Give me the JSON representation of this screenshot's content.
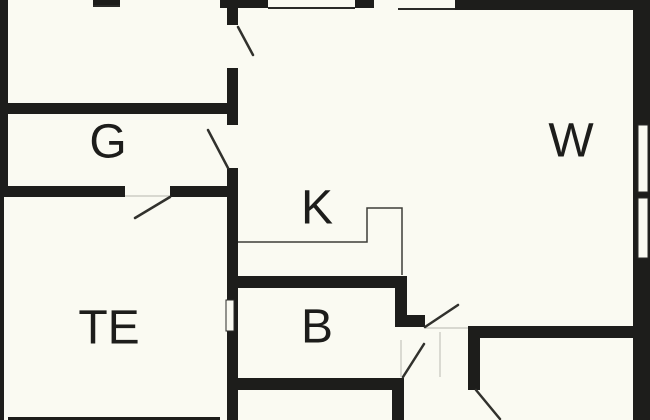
{
  "canvas": {
    "width": 650,
    "height": 420,
    "background_color": "#fafaf2",
    "wall_color": "#1d1d1b",
    "label_color": "#1d1d1b",
    "label_font_size": 48,
    "door_color": "#31312d",
    "counter_color": "#3c3c38",
    "window_line_color": "#2a2a28",
    "faint_line_color": "#c4c4bc"
  },
  "rooms": [
    {
      "label": "G",
      "x": 108,
      "y": 142
    },
    {
      "label": "W",
      "x": 571,
      "y": 141
    },
    {
      "label": "K",
      "x": 317,
      "y": 208
    },
    {
      "label": "TE",
      "x": 109,
      "y": 328
    },
    {
      "label": "B",
      "x": 317,
      "y": 327
    }
  ],
  "walls": [
    {
      "name": "wall-left-upper",
      "x": 0,
      "y": 0,
      "w": 8,
      "h": 197
    },
    {
      "name": "wall-left-lower",
      "x": 0,
      "y": 192,
      "w": 4,
      "h": 228
    },
    {
      "name": "wall-top-entry-mark",
      "x": 93,
      "y": 0,
      "w": 27,
      "h": 5
    },
    {
      "name": "wall-top-a",
      "x": 220,
      "y": 0,
      "w": 48,
      "h": 8
    },
    {
      "name": "wall-top-b",
      "x": 355,
      "y": 0,
      "w": 19,
      "h": 8
    },
    {
      "name": "wall-top-c",
      "x": 455,
      "y": 0,
      "w": 195,
      "h": 10
    },
    {
      "name": "wall-right-exterior",
      "x": 633,
      "y": 0,
      "w": 17,
      "h": 420
    },
    {
      "name": "wall-central-upper",
      "x": 227,
      "y": 7,
      "w": 11,
      "h": 18
    },
    {
      "name": "wall-central-mid",
      "x": 227,
      "y": 68,
      "w": 11,
      "h": 57
    },
    {
      "name": "wall-central-lower",
      "x": 227,
      "y": 168,
      "w": 11,
      "h": 252
    },
    {
      "name": "wall-g-divider",
      "x": 4,
      "y": 103,
      "w": 234,
      "h": 11
    },
    {
      "name": "wall-te-divider-left",
      "x": 0,
      "y": 186,
      "w": 125,
      "h": 11
    },
    {
      "name": "wall-te-divider-right",
      "x": 170,
      "y": 186,
      "w": 68,
      "h": 11
    },
    {
      "name": "wall-kb-divider",
      "x": 238,
      "y": 276,
      "w": 169,
      "h": 12
    },
    {
      "name": "wall-b-right-stub-v",
      "x": 395,
      "y": 276,
      "w": 12,
      "h": 51
    },
    {
      "name": "wall-b-right-stub-h",
      "x": 395,
      "y": 315,
      "w": 30,
      "h": 12
    },
    {
      "name": "wall-b-bottom",
      "x": 238,
      "y": 378,
      "w": 166,
      "h": 12
    },
    {
      "name": "wall-bottommid-right",
      "x": 392,
      "y": 378,
      "w": 12,
      "h": 42
    },
    {
      "name": "wall-hall-top",
      "x": 468,
      "y": 326,
      "w": 182,
      "h": 12
    },
    {
      "name": "wall-hall-left",
      "x": 468,
      "y": 338,
      "w": 12,
      "h": 52
    },
    {
      "name": "wall-bottom-edge",
      "x": 8,
      "y": 417,
      "w": 212,
      "h": 3
    }
  ],
  "windows": [
    {
      "name": "window-right-upper",
      "x": 638,
      "y": 125,
      "w": 10,
      "h": 67
    },
    {
      "name": "window-right-lower",
      "x": 638,
      "y": 198,
      "w": 10,
      "h": 60
    },
    {
      "name": "window-central-inset",
      "x": 226,
      "y": 300,
      "w": 8,
      "h": 31
    }
  ],
  "window_lines": [
    {
      "name": "window-line-top-left",
      "x1": 268,
      "y1": 8,
      "x2": 355,
      "y2": 8
    },
    {
      "name": "window-line-top-right",
      "x1": 398,
      "y1": 9,
      "x2": 455,
      "y2": 9
    },
    {
      "name": "window-line-entry-mark",
      "x1": 93,
      "y1": 6,
      "x2": 120,
      "y2": 6
    }
  ],
  "door_leaves": [
    {
      "name": "door-leaf-top-hall",
      "x1": 238,
      "y1": 27,
      "x2": 253,
      "y2": 55
    },
    {
      "name": "door-leaf-room-g",
      "x1": 228,
      "y1": 168,
      "x2": 208,
      "y2": 130
    },
    {
      "name": "door-leaf-room-te",
      "x1": 170,
      "y1": 197,
      "x2": 135,
      "y2": 218
    },
    {
      "name": "door-leaf-hall-right",
      "x1": 425,
      "y1": 327,
      "x2": 458,
      "y2": 305
    },
    {
      "name": "door-leaf-room-b",
      "x1": 403,
      "y1": 377,
      "x2": 424,
      "y2": 344
    },
    {
      "name": "door-leaf-bottom-right",
      "x1": 476,
      "y1": 390,
      "x2": 500,
      "y2": 419
    }
  ],
  "counter_path": [
    [
      238,
      242
    ],
    [
      367,
      242
    ],
    [
      367,
      208
    ],
    [
      402,
      208
    ],
    [
      402,
      275
    ]
  ],
  "faint_lines": [
    {
      "name": "threshold-b-opening",
      "x1": 401,
      "y1": 340,
      "x2": 401,
      "y2": 377
    },
    {
      "name": "threshold-corridor",
      "x1": 440,
      "y1": 332,
      "x2": 440,
      "y2": 377
    },
    {
      "name": "threshold-hall-opening",
      "x1": 425,
      "y1": 328,
      "x2": 468,
      "y2": 328
    },
    {
      "name": "threshold-te-opening",
      "x1": 125,
      "y1": 196,
      "x2": 170,
      "y2": 196
    }
  ]
}
